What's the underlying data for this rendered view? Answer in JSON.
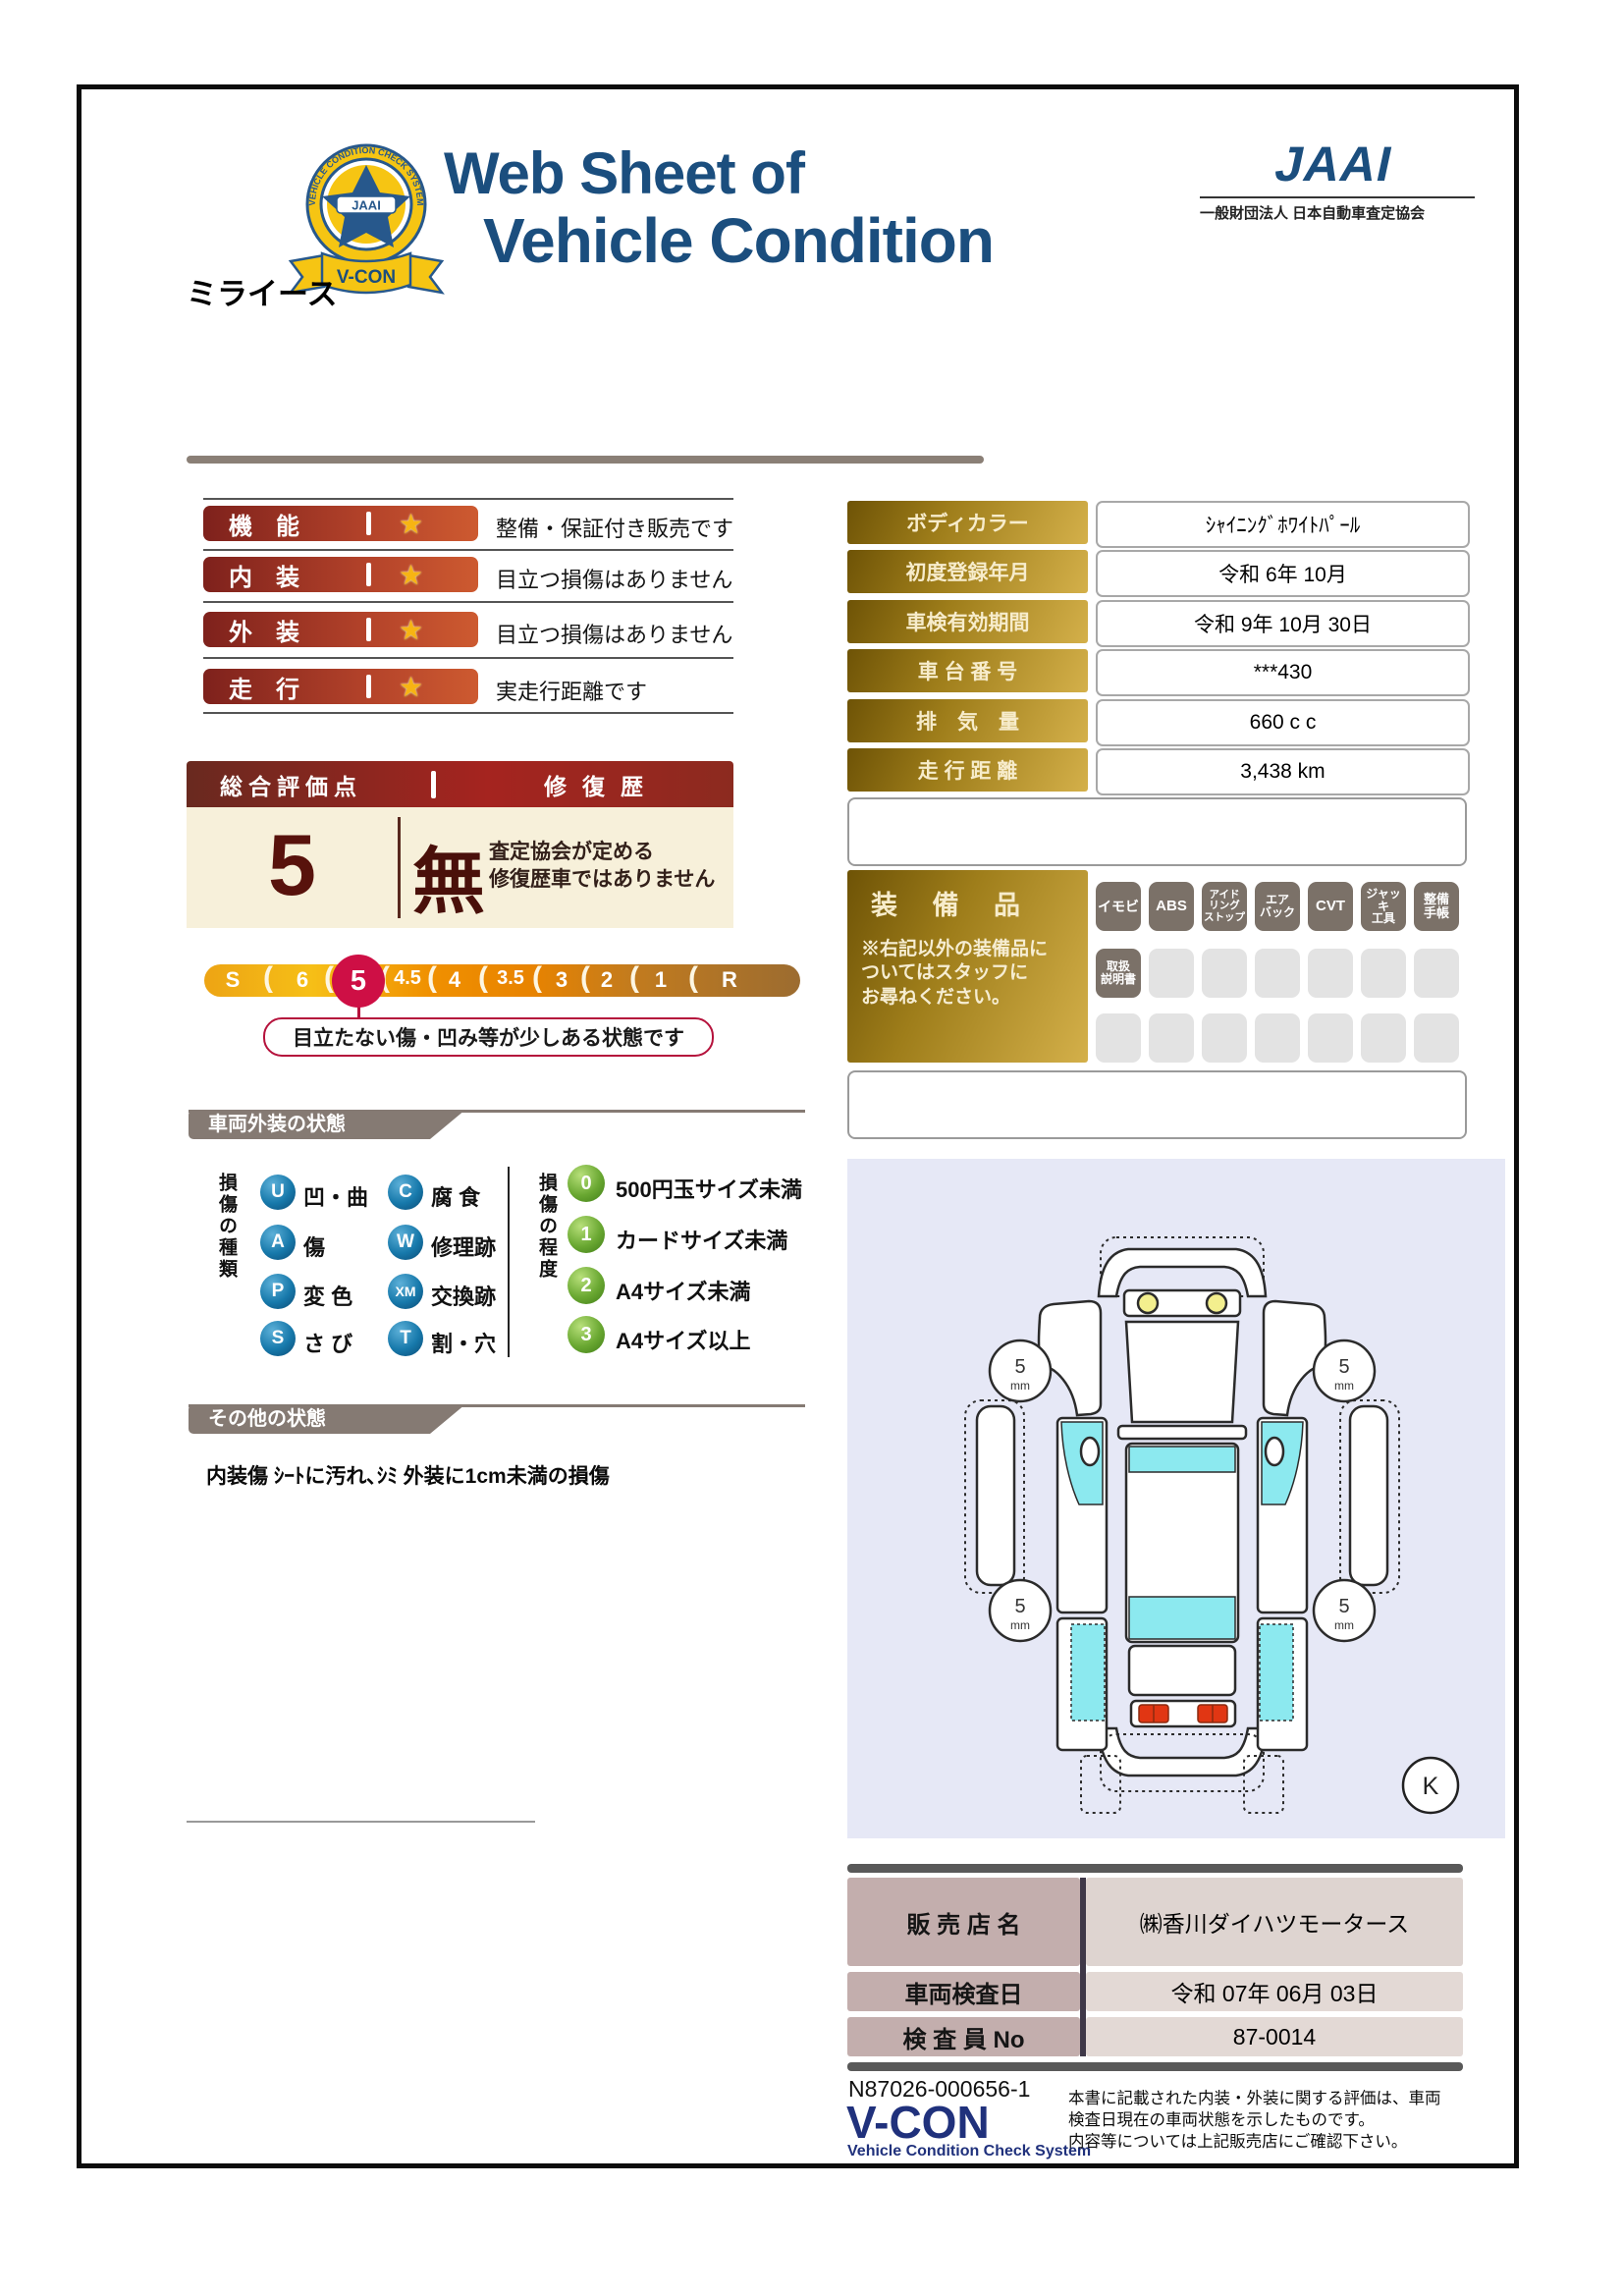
{
  "header": {
    "title_line1": "Web Sheet of",
    "title_line2": "Vehicle Condition",
    "jaai_logo": "JAAI",
    "jaai_subtitle": "一般財団法人 日本自動車査定協会",
    "badge": {
      "ring_text": "VEHICLE CONDITION CHECK SYSTEM",
      "star_label": "JAAI",
      "ribbon": "V-CON"
    },
    "vehicle_name": "ミライース"
  },
  "star_icon": "★",
  "ratings": [
    {
      "label": "機　能",
      "comment": "整備・保証付き販売です"
    },
    {
      "label": "内　装",
      "comment": "目立つ損傷はありません"
    },
    {
      "label": "外　装",
      "comment": "目立つ損傷はありません"
    },
    {
      "label": "走　行",
      "comment": "実走行距離です"
    }
  ],
  "spec_table": {
    "rows": [
      {
        "label": "ボディカラー",
        "value": "ｼｬｲﾆﾝｸﾞﾎﾜｲﾄﾊﾟｰﾙ"
      },
      {
        "label": "初度登録年月",
        "value": "令和 6年 10月"
      },
      {
        "label": "車検有効期間",
        "value": "令和 9年 10月 30日"
      },
      {
        "label": "車 台 番 号",
        "value": "***430"
      },
      {
        "label": "排　気　量",
        "value": "660 c c"
      },
      {
        "label": "走 行 距 離",
        "value": "3,438 km"
      }
    ]
  },
  "equipment": {
    "label": "装 備 品",
    "note": "※右記以外の装備品に\nついてはスタッフに\nお尋ねください。",
    "chips_row1": [
      "イモビ",
      "ABS",
      "アイド\nリング\nストップ",
      "エア\nバック",
      "CVT",
      "ジャッキ\n工具",
      "整備\n手帳"
    ],
    "chips_row2_first": "取扱\n説明書"
  },
  "score": {
    "header_left": "総合評価点",
    "header_right": "修復歴",
    "value": "5",
    "repair": "無",
    "repair_note": "査定協会が定める\n修復歴車ではありません"
  },
  "scale": {
    "items": [
      "S",
      "6",
      "5",
      "4.5",
      "4",
      "3.5",
      "3",
      "2",
      "1",
      "R"
    ],
    "selected": "5",
    "separator_glyph": "(",
    "callout": "目立たない傷・凹み等が少しある状態です"
  },
  "exterior_section": {
    "title": "車両外装の状態",
    "types_title": "損傷の種類",
    "types": [
      {
        "code": "U",
        "label": "凹・曲"
      },
      {
        "code": "A",
        "label": "傷"
      },
      {
        "code": "P",
        "label": "変 色"
      },
      {
        "code": "S",
        "label": "さ び"
      },
      {
        "code": "C",
        "label": "腐 食"
      },
      {
        "code": "W",
        "label": "修理跡"
      },
      {
        "code": "XM",
        "label": "交換跡"
      },
      {
        "code": "T",
        "label": "割・穴"
      }
    ],
    "degrees_title": "損傷の程度",
    "degrees": [
      {
        "code": "0",
        "label": "500円玉サイズ未満"
      },
      {
        "code": "1",
        "label": "カードサイズ未満"
      },
      {
        "code": "2",
        "label": "A4サイズ未満"
      },
      {
        "code": "3",
        "label": "A4サイズ以上"
      }
    ]
  },
  "other_section": {
    "title": "その他の状態",
    "text": "内装傷 ｼｰﾄに汚れ､ｼﾐ 外装に1cm未満の損傷"
  },
  "diagram": {
    "wheel_label_top": "5",
    "wheel_label_bottom": "mm",
    "marker": "K"
  },
  "dealer_table": {
    "rows": [
      {
        "label": "販 売 店 名",
        "value": "㈱香川ダイハツモータース"
      },
      {
        "label": "車両検査日",
        "value": "令和 07年 06月 03日"
      },
      {
        "label": "検 査 員 No",
        "value": "87-0014"
      }
    ]
  },
  "footer": {
    "serial": "N87026-000656-1",
    "logo": "V-CON",
    "logo_sub": "Vehicle Condition Check System",
    "disclaimer": "本書に記載された内装・外装に関する評価は、車両\n検査日現在の車両状態を示したものです。\n内容等については上記販売店にご確認下さい。"
  },
  "colors": {
    "accent_navy": "#1b4e7e",
    "pill_red": "#a5241f",
    "gold": "#9e7d1a",
    "scale_orange": "#f09000",
    "selected_crimson": "#ce0f45",
    "section_taupe": "#857a73",
    "diagram_lavender": "#e6e8f6",
    "window_cyan": "#8ce9ef"
  }
}
